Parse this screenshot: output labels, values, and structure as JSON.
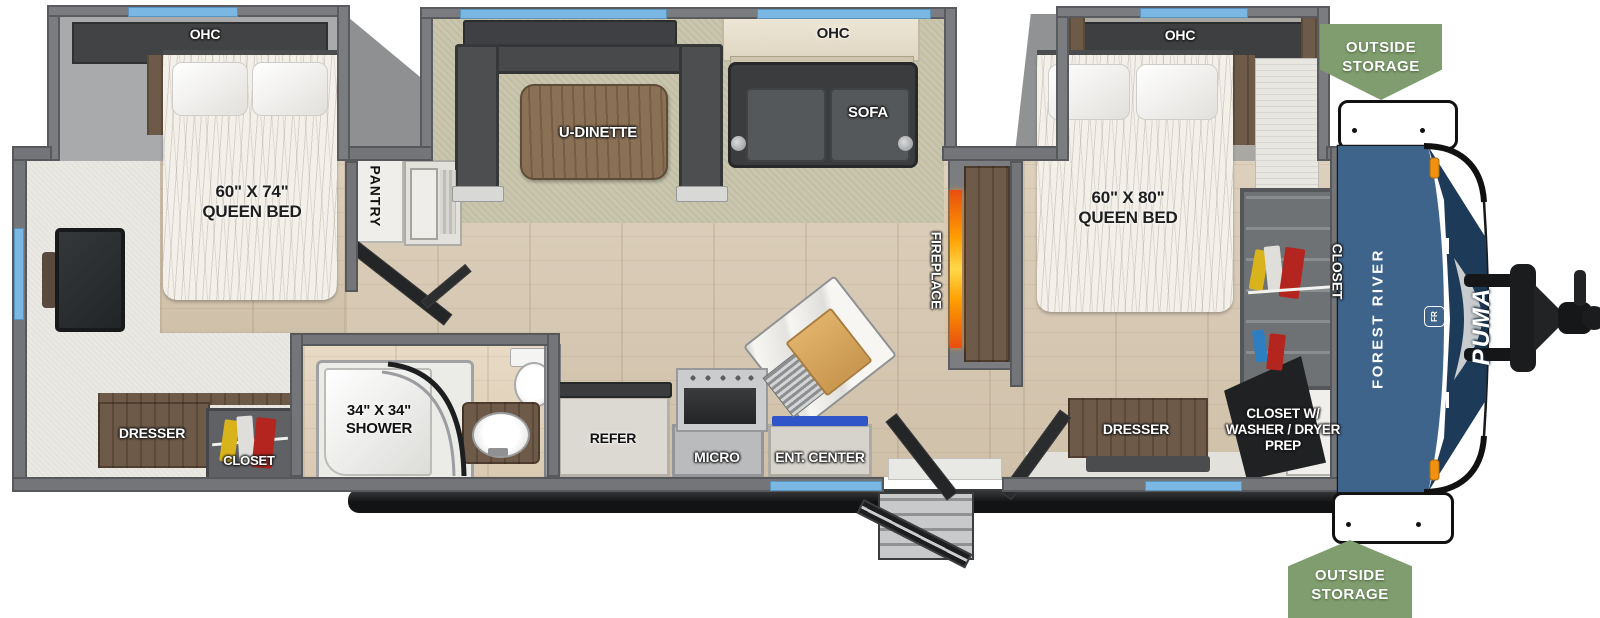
{
  "floorplan": {
    "brand": {
      "maker": "FOREST RIVER",
      "model": "PUMA",
      "logo_monogram": "FR"
    },
    "badges": {
      "outside_storage_top": {
        "line1": "OUTSIDE",
        "line2": "STORAGE"
      },
      "outside_storage_bottom": {
        "line1": "OUTSIDE",
        "line2": "STORAGE"
      }
    },
    "bedroom_rear": {
      "ohc": "OHC",
      "bed_size": "60\" X 74\"",
      "bed_name": "QUEEN BED",
      "pantry": "PANTRY",
      "dresser": "DRESSER",
      "closet": "CLOSET"
    },
    "living": {
      "dinette": "U-DINETTE",
      "sofa_ohc": "OHC",
      "sofa": "SOFA",
      "fireplace": "FIREPLACE"
    },
    "bathroom": {
      "shower_size": "34\" X 34\"",
      "shower_name": "SHOWER"
    },
    "kitchen": {
      "refrigerator": "REFER",
      "microwave": "MICRO",
      "entertainment_center": "ENT. CENTER"
    },
    "bedroom_front": {
      "ohc": "OHC",
      "bed_size": "60\" X 80\"",
      "bed_name": "QUEEN BED",
      "closet": "CLOSET",
      "dresser": "DRESSER",
      "wd_closet_line1": "CLOSET W/",
      "wd_closet_line2": "WASHER / DRYER",
      "wd_closet_line3": "PREP"
    },
    "palette": {
      "badge_green": "#7f9d6e",
      "cap_blue": "#3e648c",
      "cap_navy": "#1d3b58",
      "window_blue": "#7ab7e2",
      "fireplace_orange": "#ff9e00",
      "accent_blue": "#2f55c8",
      "wall_gray": "#737578",
      "floor_tan": "#d8cab5"
    }
  }
}
